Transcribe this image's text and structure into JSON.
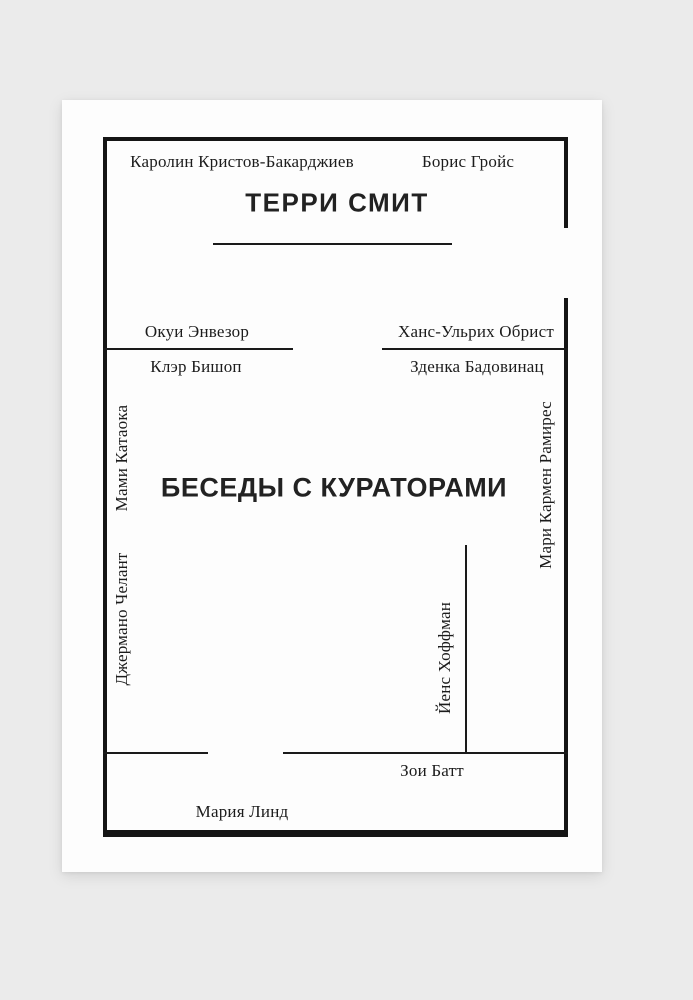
{
  "cover": {
    "author": "ТЕРРИ СМИТ",
    "title": "БЕСЕДЫ С КУРАТОРАМИ",
    "curators": {
      "top_left": "Каролин Кристов-Бакарджиев",
      "top_right": "Борис Гройс",
      "mid_left_above_line": "Окуи Энвезор",
      "mid_right_above_line": "Ханс-Ульрих Обрист",
      "mid_left_below_line": "Клэр Бишоп",
      "mid_right_below_line": "Зденка Бадовинац",
      "left_vertical_upper": "Мами Катаока",
      "left_vertical_lower": "Джермано Челант",
      "right_vertical": "Мари Кармен Рамирес",
      "inner_vertical": "Йенс Хоффман",
      "bottom_right": "Зои Батт",
      "bottom_left": "Мария Линд"
    },
    "colors": {
      "page_background": "#ebebeb",
      "card_background": "#fdfdfd",
      "frame_ink": "#151515",
      "text_ink": "#1c1c1c"
    }
  }
}
